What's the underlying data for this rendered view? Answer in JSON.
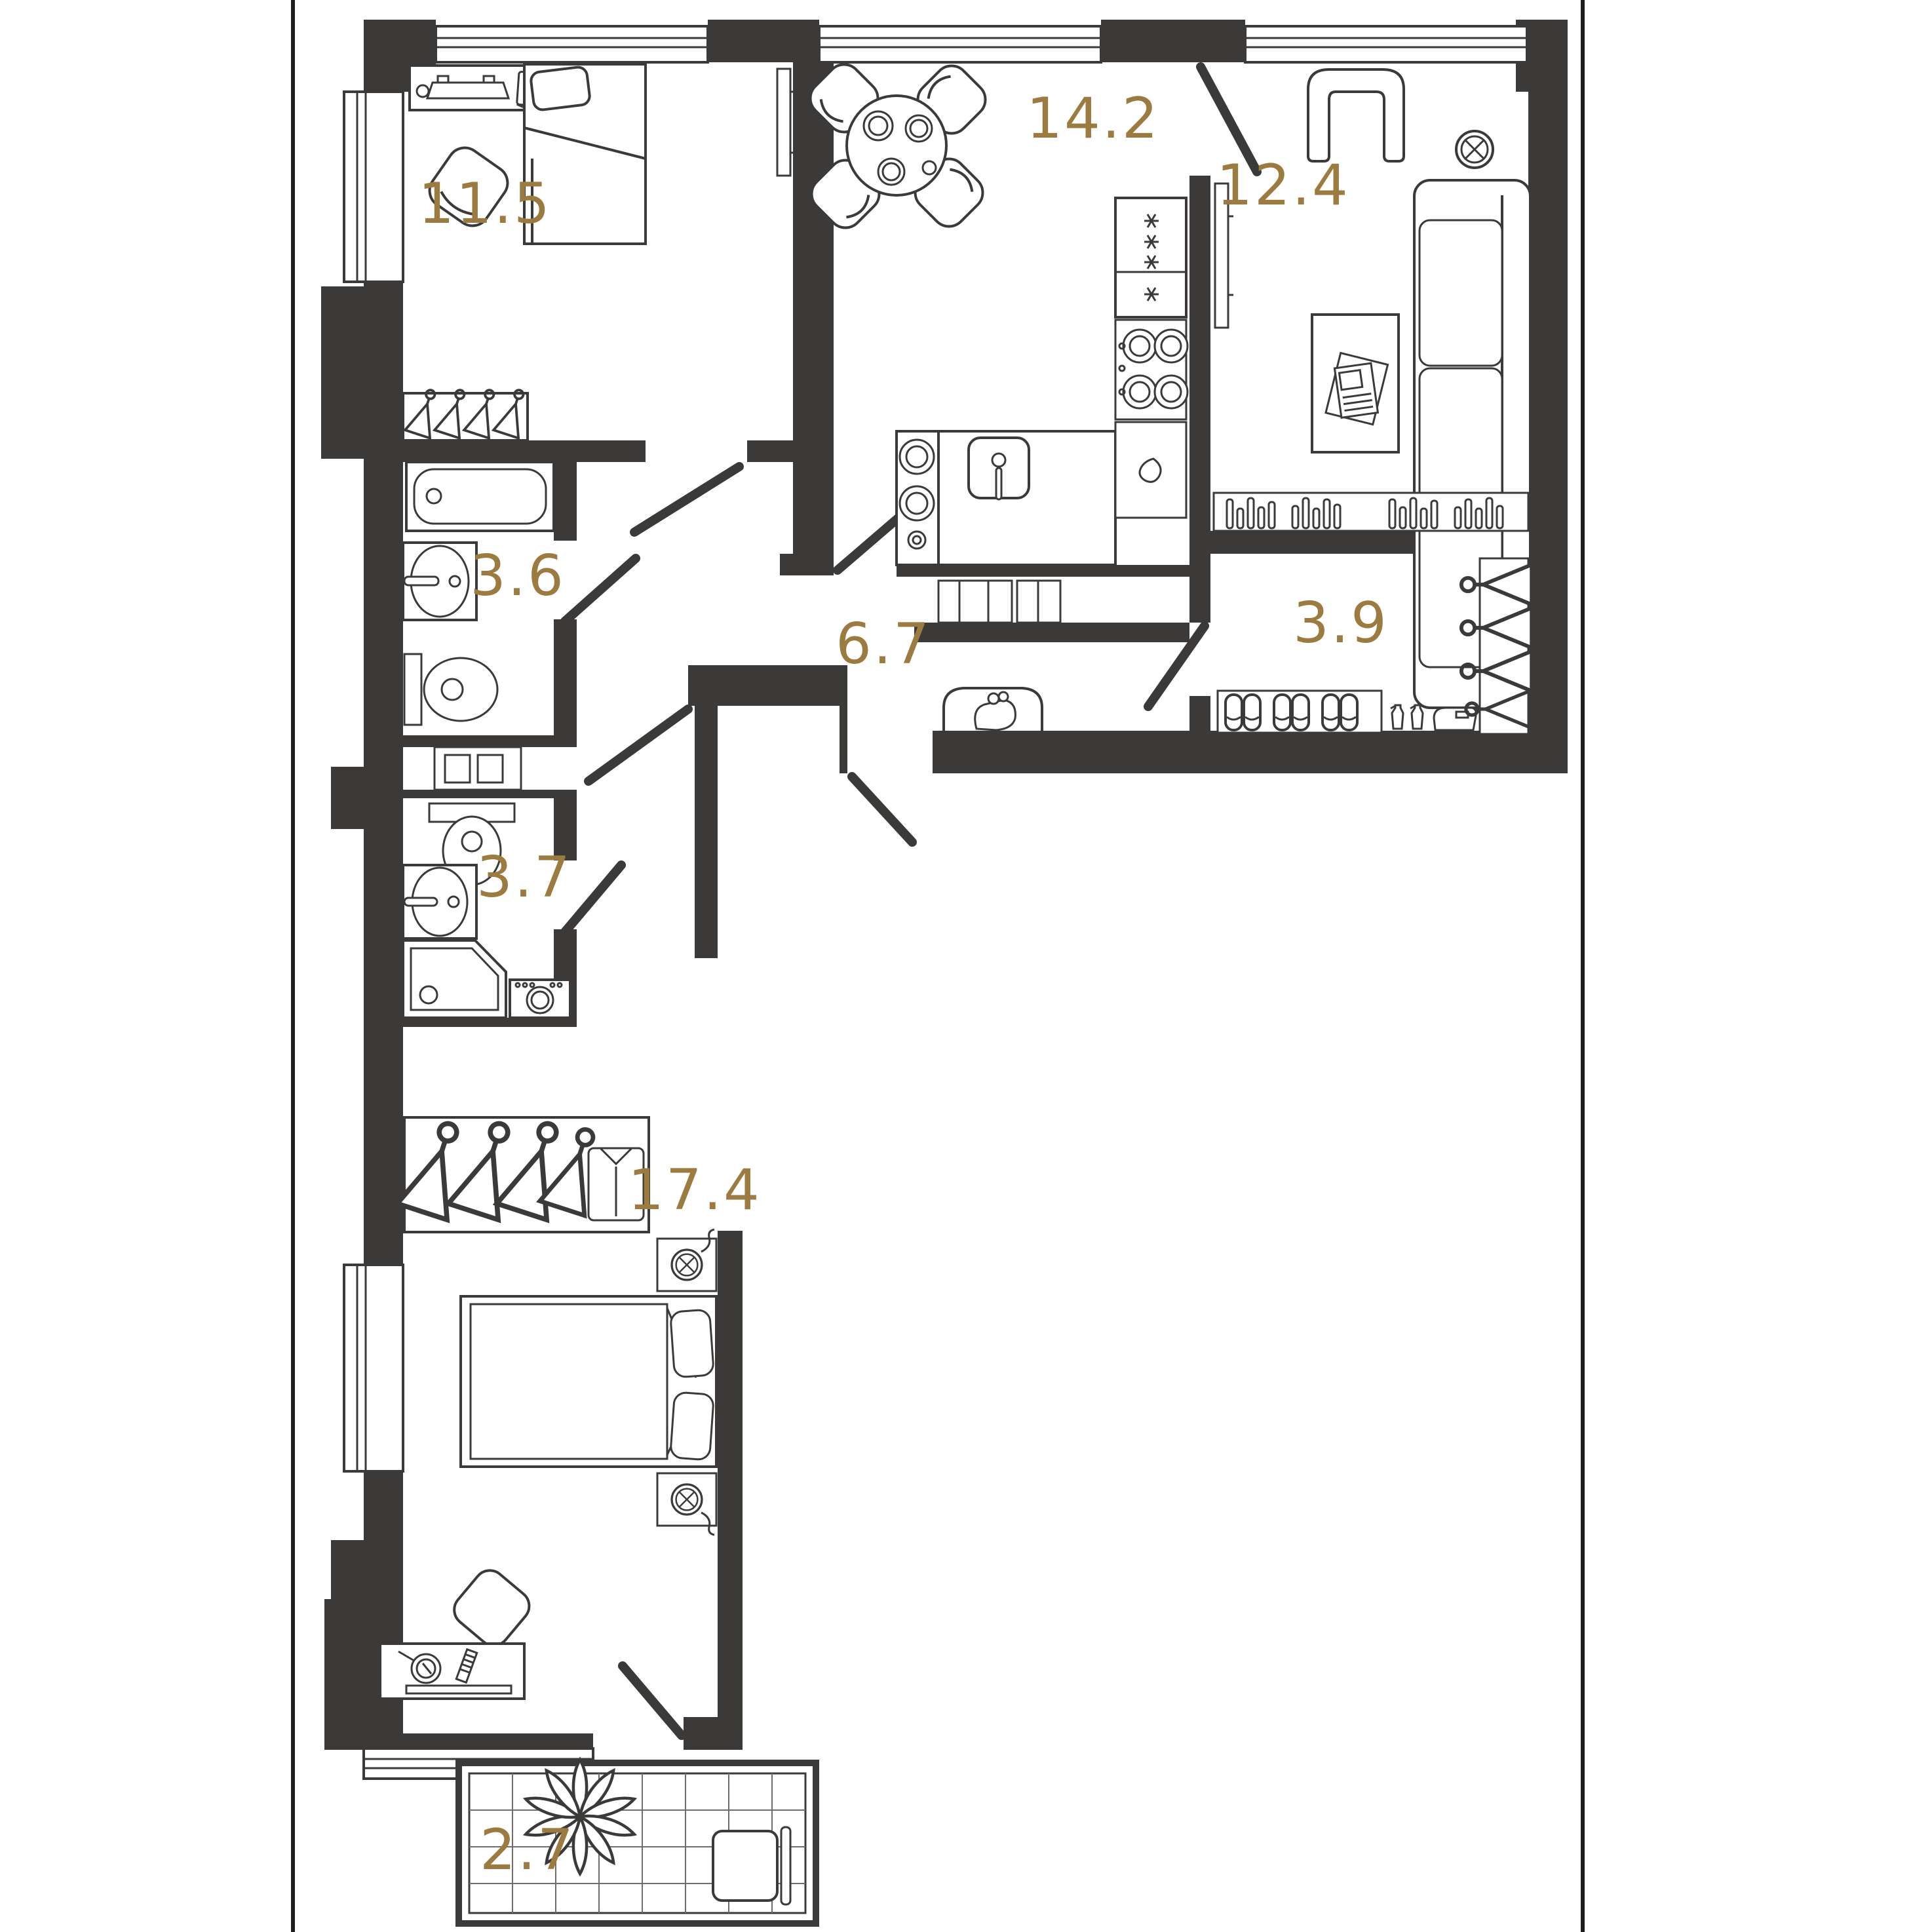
{
  "plan": {
    "type": "apartment-floor-plan",
    "background_color": "#ffffff",
    "wall_color": "#3b3a38",
    "line_color": "#3b3a38",
    "label_color": "#9b7b40",
    "rooms": [
      {
        "id": "bedroom-1",
        "name": "bedroom",
        "area": "11.5",
        "furniture": [
          "desk-icon",
          "monitor-icon",
          "laptop-icon",
          "chair-icon",
          "single-bed-icon",
          "hanger-rail-icon",
          "window-icon",
          "door-icon"
        ]
      },
      {
        "id": "kitchen-dining",
        "name": "kitchen-dining",
        "area": "14.2",
        "furniture": [
          "round-table-icon",
          "chairs-icon",
          "plates-icon",
          "tv-icon",
          "sink-icon",
          "hob-icon",
          "fridge-icon",
          "counter-icon",
          "window-icon",
          "door-icon"
        ]
      },
      {
        "id": "living-room",
        "name": "living-room",
        "area": "12.4",
        "furniture": [
          "armchair-icon",
          "sofa-icon",
          "coffee-table-icon",
          "magazine-icon",
          "ceiling-lamp-icon",
          "bookshelf-icon",
          "tv-icon",
          "window-icon",
          "door-icon"
        ]
      },
      {
        "id": "bathroom-1",
        "name": "bathroom",
        "area": "3.6",
        "furniture": [
          "bathtub-icon",
          "washbasin-icon",
          "toilet-icon",
          "door-icon"
        ]
      },
      {
        "id": "hallway",
        "name": "hallway",
        "area": "6.7",
        "furniture": [
          "bench-icon",
          "purse-icon",
          "entrance-door-icon"
        ]
      },
      {
        "id": "wardrobe",
        "name": "walk-in-wardrobe",
        "area": "3.9",
        "furniture": [
          "hangers-icon",
          "slippers-icon",
          "spray-bottles-icon",
          "iron-icon",
          "shelf-icon",
          "door-icon"
        ]
      },
      {
        "id": "bathroom-2",
        "name": "bathroom",
        "area": "3.7",
        "furniture": [
          "toilet-icon",
          "washbasin-icon",
          "corner-shower-icon",
          "washing-machine-icon",
          "door-icon"
        ]
      },
      {
        "id": "bedroom-2",
        "name": "bedroom",
        "area": "17.4",
        "furniture": [
          "double-bed-icon",
          "pillows-icon",
          "nightstand-icon",
          "lamp-icon",
          "dressing-table-icon",
          "mirror-icon",
          "comb-icon",
          "chair-icon",
          "wardrobe-shirt-icon",
          "window-icon"
        ]
      },
      {
        "id": "balcony",
        "name": "balcony",
        "area": "2.7",
        "furniture": [
          "plant-icon",
          "chair-icon",
          "tile-floor",
          "balcony-door-icon"
        ]
      }
    ]
  }
}
